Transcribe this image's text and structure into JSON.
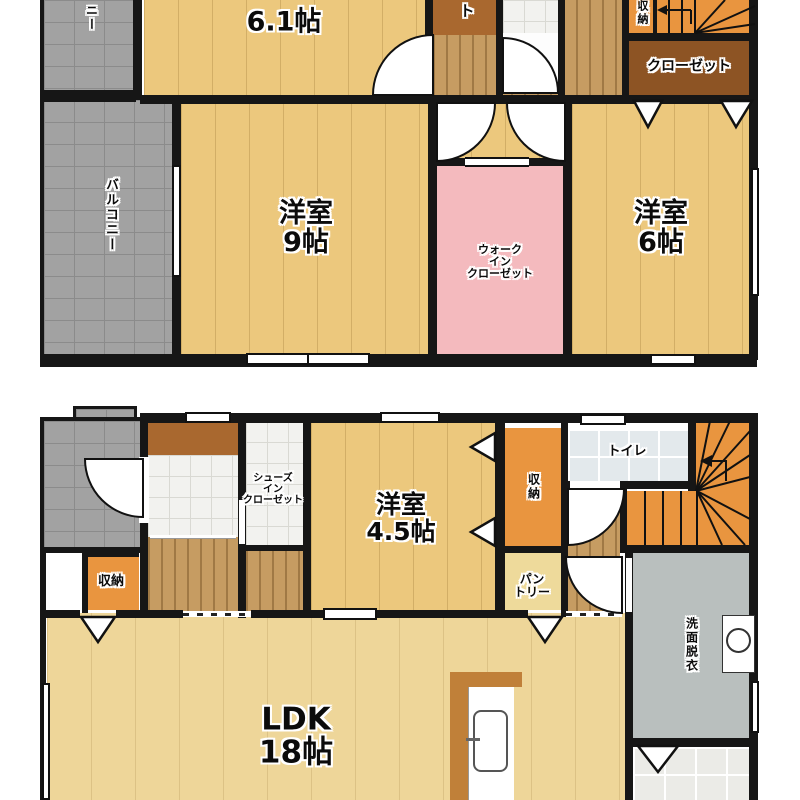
{
  "plan_title": "2-story house floor plan",
  "colors": {
    "wood_floor": "#ecc87d",
    "ldk_floor": "#eed699",
    "hall_wood": "#c69c62",
    "balcony_gray": "#a2a2a2",
    "closet_brown": "#8d5424",
    "storage_orange": "#e9953f",
    "wic_pink": "#f4babe",
    "washroom_gray": "#b9bfbe",
    "wall_black": "#161616"
  },
  "floor2": {
    "room_6_1": {
      "size": "6.1帖"
    },
    "closet_top_partial": "ト",
    "storage": "収納",
    "closet": "クローゼット",
    "balcony_top_partial": "ニー",
    "balcony": "バルコニー",
    "room_9": {
      "name": "洋室",
      "size": "9帖"
    },
    "wic": {
      "line1": "ウォーク",
      "line2": "イン",
      "line3": "クローゼット"
    },
    "room_6": {
      "name": "洋室",
      "size": "6帖"
    }
  },
  "floor1": {
    "sic": {
      "line1": "シューズ",
      "line2": "イン",
      "line3": "クローゼット"
    },
    "storage_left": "収納",
    "room_4_5": {
      "name": "洋室",
      "size": "4.5帖"
    },
    "storage_right": "収納",
    "toilet": "トイレ",
    "pantry": {
      "line1": "パン",
      "line2": "トリー"
    },
    "washroom": "洗面脱衣",
    "ldk": {
      "name": "LDK",
      "size": "18帖"
    }
  }
}
